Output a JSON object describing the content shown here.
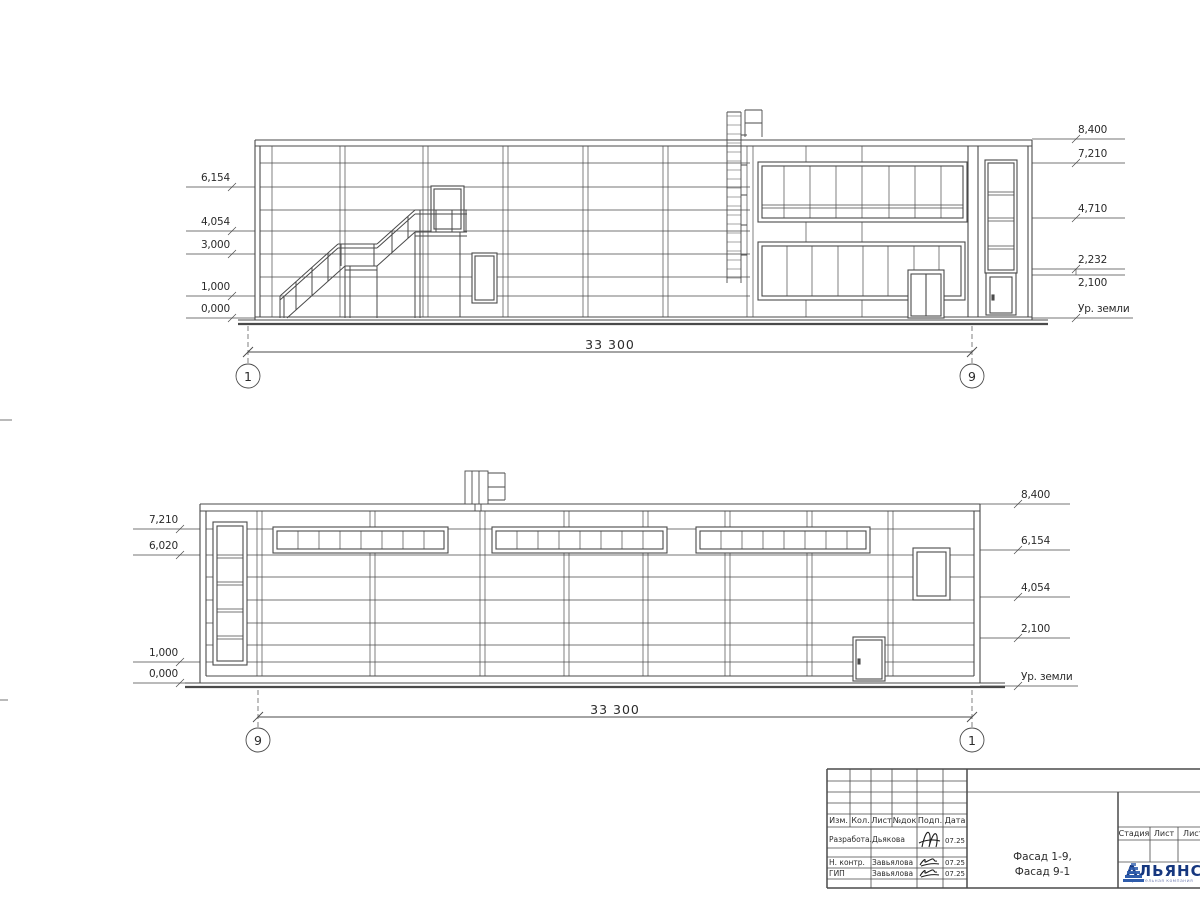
{
  "sheet": {
    "facade_top": {
      "left_marks": [
        "6,154",
        "4,054",
        "3,000",
        "1,000",
        "0,000"
      ],
      "right_marks": [
        "8,400",
        "7,210",
        "4,710",
        "2,232",
        "2,100",
        "Ур. земли"
      ],
      "dimension": "33 300",
      "axis_left": "1",
      "axis_right": "9"
    },
    "facade_bottom": {
      "left_marks": [
        "7,210",
        "6,020",
        "1,000",
        "0,000"
      ],
      "right_marks": [
        "8,400",
        "6,154",
        "4,054",
        "2,100",
        "Ур. земли"
      ],
      "dimension": "33 300",
      "axis_left": "9",
      "axis_right": "1"
    }
  },
  "title_block": {
    "revision_columns": [
      "Изм.",
      "Кол.",
      "Лист",
      "№док",
      "Подп.",
      "Дата"
    ],
    "staff_rows": [
      {
        "role": "Разработал",
        "name": "Дьякова",
        "date": "07.25"
      },
      {
        "role": "Н. контр.",
        "name": "Завьялова",
        "date": "07.25"
      },
      {
        "role": "ГИП",
        "name": "Завьялова",
        "date": "07.25"
      }
    ],
    "drawing_title": {
      "line1": "Фасад 1-9,",
      "line2": "Фасад 9-1"
    },
    "stage_columns": [
      "Стадия",
      "Лист",
      "Листов"
    ],
    "logo": {
      "name": "АЛЬЯНС",
      "subtitle": "строительная компания"
    }
  },
  "colors": {
    "line": "#4a4a4a",
    "logo_text": "#16377f",
    "logo_pyramid": "#2e5cab",
    "logo_subtitle": "#7d88b8"
  }
}
